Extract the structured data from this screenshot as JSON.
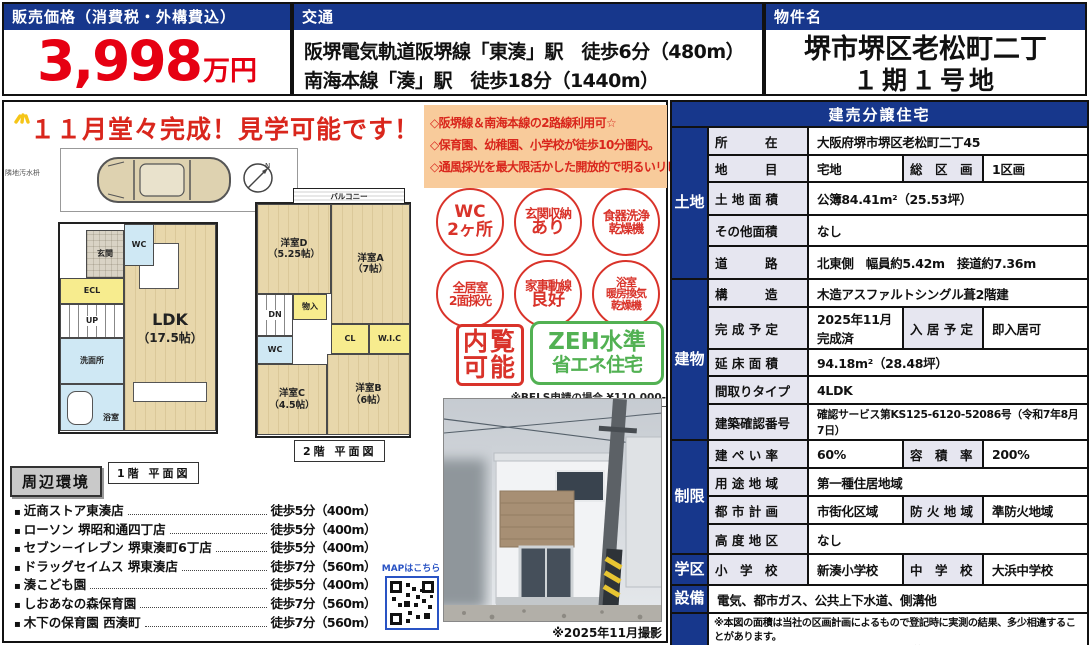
{
  "top": {
    "price": {
      "header": "販売価格（消費税・外構費込）",
      "amount": "3,998",
      "unit": "万円"
    },
    "access": {
      "header": "交通",
      "line1": "阪堺電気軌道阪堺線「東湊」駅　徒歩6分（480m）",
      "line2": "南海本線「湊」駅　徒歩18分（1440m）"
    },
    "property": {
      "header": "物件名",
      "line1": "堺市堺区老松町二丁",
      "line2": "１期１号地"
    }
  },
  "headline": "１１月堂々完成！見学可能です！",
  "features": {
    "item1": "◇阪堺線＆南海本線の2路線利用可☆",
    "item2": "◇保育園、幼稚園、小学校が徒歩10分圏内。",
    "item3": "◇通風採光を最大限活かした開放的で明るいリビング"
  },
  "badges": [
    {
      "lines": [
        "WC",
        "2ヶ所"
      ]
    },
    {
      "lines": [
        "玄関収納",
        "あり"
      ]
    },
    {
      "lines": [
        "食器洗浄",
        "乾燥機"
      ]
    },
    {
      "lines": [
        "全居室",
        "2面採光"
      ]
    },
    {
      "lines": [
        "家事動線",
        "良好"
      ]
    },
    {
      "lines": [
        "浴室",
        "暖房換気",
        "乾燥機"
      ]
    }
  ],
  "stamps": {
    "naikan_line1": "内覧",
    "naikan_line2": "可能",
    "zeh_line1": "ZEH水準",
    "zeh_line2": "省エネ住宅",
    "bels_note": "※BELS申請の場合 ¥110,000-"
  },
  "floorplan": {
    "note": "隣地汚水枡",
    "compass": "N",
    "f1": {
      "caption": "1階 平面図",
      "ldk": "LDK",
      "ldk_size": "（17.5帖）",
      "wc": "WC",
      "genkan": "玄関",
      "ecl": "ECL",
      "up": "UP",
      "senmen": "洗面所",
      "bath": "浴室"
    },
    "f2": {
      "caption": "2階 平面図",
      "balcony": "バルコニー",
      "room_d": "洋室D",
      "room_d_size": "（5.25帖）",
      "room_a": "洋室A",
      "room_a_size": "（7帖）",
      "room_c": "洋室C",
      "room_c_size": "（4.5帖）",
      "room_b": "洋室B",
      "room_b_size": "（6帖）",
      "dn": "DN",
      "mono": "物入",
      "wc": "WC",
      "cl": "CL",
      "wic": "W.I.C"
    }
  },
  "surroundings": {
    "title": "周辺環境",
    "items": [
      {
        "name": "近商ストア東湊店",
        "distance": "徒歩5分（400m）"
      },
      {
        "name": "ローソン 堺昭和通四丁店",
        "distance": "徒歩5分（400m）"
      },
      {
        "name": "セブン－イレブン 堺東湊町6丁店",
        "distance": "徒歩5分（400m）"
      },
      {
        "name": "ドラッグセイムス 堺東湊店",
        "distance": "徒歩7分（560m）"
      },
      {
        "name": "湊こども園",
        "distance": "徒歩5分（400m）"
      },
      {
        "name": "しおあなの森保育園",
        "distance": "徒歩7分（560m）"
      },
      {
        "name": "木下の保育園 西湊町",
        "distance": "徒歩7分（560m）"
      }
    ]
  },
  "map": {
    "label": "MAPはこちら"
  },
  "photo": {
    "caption": "※2025年11月撮影"
  },
  "spec": {
    "title": "建売分譲住宅",
    "groups": {
      "land": "土地",
      "building": "建物",
      "limits": "制限",
      "school": "学区",
      "equip": "設備"
    },
    "rows": [
      {
        "label": "所　　　在",
        "value": "大阪府堺市堺区老松町二丁45"
      },
      {
        "label": "地　　　目",
        "value": "宅地",
        "label2": "総　区　画",
        "value2": "1区画"
      },
      {
        "label": "土 地 面 積",
        "value": "公簿84.41m²（25.53坪）"
      },
      {
        "label": "その他面積",
        "value": "なし"
      },
      {
        "label": "道　　　路",
        "value": "北東側　幅員約5.42m　接道約7.36m"
      },
      {
        "label": "構　　　造",
        "value": "木造アスファルトシングル葺2階建"
      },
      {
        "label": "完 成 予 定",
        "value": "2025年11月完成済",
        "label2": "入 居 予 定",
        "value2": "即入居可"
      },
      {
        "label": "延 床 面 積",
        "value": "94.18m²（28.48坪）"
      },
      {
        "label": "間取りタイプ",
        "value": "4LDK"
      },
      {
        "label": "建築確認番号",
        "value": "確認サービス第KS125-6120-52086号（令和7年8月7日）"
      },
      {
        "label": "建 ぺ い 率",
        "value": "60%",
        "label2": "容　積　率",
        "value2": "200%"
      },
      {
        "label": "用 途 地 域",
        "value": "第一種住居地域"
      },
      {
        "label": "都 市 計 画",
        "value": "市街化区域",
        "label2": "防 火 地 域",
        "value2": "準防火地域"
      },
      {
        "label": "高 度 地 区",
        "value": "なし"
      },
      {
        "label": "小　学　校",
        "value": "新湊小学校",
        "label2": "中　学　校",
        "value2": "大浜中学校"
      },
      {
        "value": "電気、都市ガス、公共上下水道、側溝他"
      }
    ],
    "notes": [
      "※本図の面積は当社の区画計画によるもので登記時に実測の結果、多少相違することがあります。",
      "※TVアンテナ・網戸・照明・カーテンレール等はオプションになります。",
      "※間取り図面の家具・車等は販売価格に含まれません。"
    ]
  },
  "colors": {
    "navy": "#17378c",
    "price_red": "#e60012",
    "accent_red": "#d9332a",
    "feature_bg": "#f8cb9b",
    "zeh_green": "#52b153",
    "label_bg": "#e6e6f0",
    "qr_blue": "#2953c4"
  }
}
